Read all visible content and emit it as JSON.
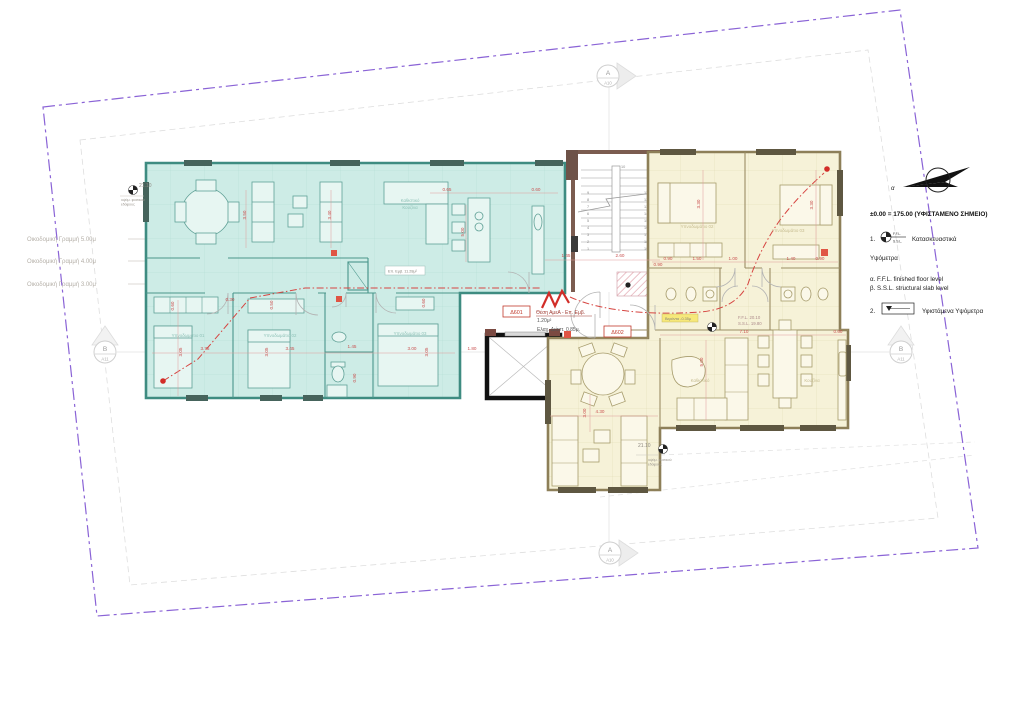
{
  "drawing": {
    "legend": {
      "title": "±0.00 = 175.00 (ΥΦΙΣΤΑΜΕΝΟ ΣΗΜΕΙΟ)",
      "item1_no": "1.",
      "ffl_abbr": "F.F.L.",
      "ssl_abbr": "S.S.L.",
      "item1_text": "Κατασκευαστικά",
      "item1_text2": "Υψόμετρα",
      "note_a": "α. F.F.L. finished floor level",
      "note_b": "β. S.S.L. structural slab level",
      "item2_no": "2.",
      "item2_text": "Υφιστάμενα Υψόμετρα"
    },
    "north": {
      "label": "α"
    },
    "site": {
      "building_lines": [
        {
          "label": "Οικοδομική Γραμμή 5.00μ"
        },
        {
          "label": "Οικοδομική Γραμμή 4.00μ"
        },
        {
          "label": "Οικοδομική Γραμμή 3.00μ"
        }
      ]
    },
    "markers": {
      "a": {
        "letter": "A",
        "ref": "A10"
      },
      "b": {
        "letter": "B",
        "ref": "A11"
      }
    },
    "levels": {
      "existing": "21.10",
      "existing_sub1": "υψόμ. φυσικού",
      "existing_sub2": "εδάφους",
      "ffl": "F.F.L. 20.10",
      "ssl": "S.S.L. 19.80"
    },
    "annotations": {
      "d601": "Δ601",
      "d602": "Δ602",
      "amea1": "Θέση ΑμεΑ - Επ. Εμβ.",
      "amea2": "1.20μ²",
      "amea3": "Ελαχ. Διάστ. 0.85μ.",
      "area_box": "Επ. Εμβ. 11.28μ²",
      "terrace": "Βεράντα -0.35μ"
    },
    "rooms": [
      {
        "t": "Καθιστικό"
      },
      {
        "t": "Κουζίνα"
      },
      {
        "t": "Υπνοδωμάτιο 01"
      },
      {
        "t": "Υπνοδωμάτιο 02"
      },
      {
        "t": "Υπνοδωμάτιο 03"
      },
      {
        "t": "Υπνοδωμάτιο 02"
      },
      {
        "t": "Υπνοδωμάτιο 03"
      },
      {
        "t": "Καθιστικό"
      },
      {
        "t": "Κουζίνα"
      }
    ],
    "dims": [
      {
        "t": "3.50"
      },
      {
        "t": "3.40"
      },
      {
        "t": "0.65"
      },
      {
        "t": "0.60"
      },
      {
        "t": "5.00"
      },
      {
        "t": "1.45"
      },
      {
        "t": "2.60"
      },
      {
        "t": "0.90"
      },
      {
        "t": "0.60"
      },
      {
        "t": "3.05"
      },
      {
        "t": "3.75"
      },
      {
        "t": "3.05"
      },
      {
        "t": "3.45"
      },
      {
        "t": "0.50"
      },
      {
        "t": "0.30"
      },
      {
        "t": "1.45"
      },
      {
        "t": "0.90"
      },
      {
        "t": "3.00"
      },
      {
        "t": "3.05"
      },
      {
        "t": "1.80"
      },
      {
        "t": "0.60"
      },
      {
        "t": "0.90"
      },
      {
        "t": "1.50"
      },
      {
        "t": "1.00"
      },
      {
        "t": "1.40"
      },
      {
        "t": "0.90"
      },
      {
        "t": "3.30"
      },
      {
        "t": "3.30"
      },
      {
        "t": "7.10"
      },
      {
        "t": "0.60"
      },
      {
        "t": "5.00"
      },
      {
        "t": "4.30"
      },
      {
        "t": "3.00"
      }
    ],
    "stairs": {
      "top": "10",
      "left": [
        "1",
        "2",
        "3",
        "4",
        "5",
        "6",
        "7",
        "8",
        "9"
      ],
      "right": [
        "11",
        "12",
        "13",
        "14",
        "15",
        "16",
        "17",
        "18",
        "19"
      ]
    }
  }
}
